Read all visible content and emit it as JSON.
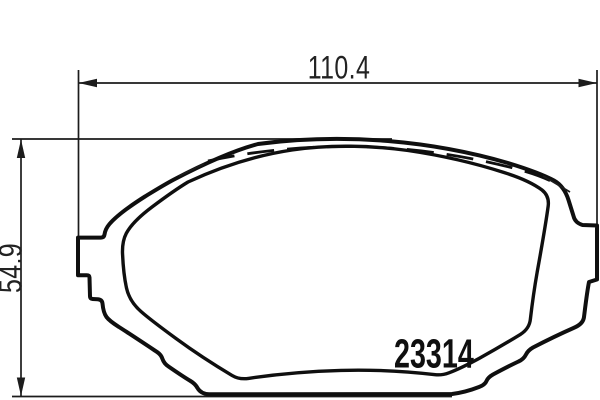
{
  "diagram": {
    "part_number": "23314",
    "width_dim": {
      "value": "110.4"
    },
    "height_dim": {
      "value": "54.9"
    },
    "colors": {
      "line": "#0f0f0f",
      "dimension_line": "#1c1c1c",
      "background": "#ffffff"
    }
  }
}
